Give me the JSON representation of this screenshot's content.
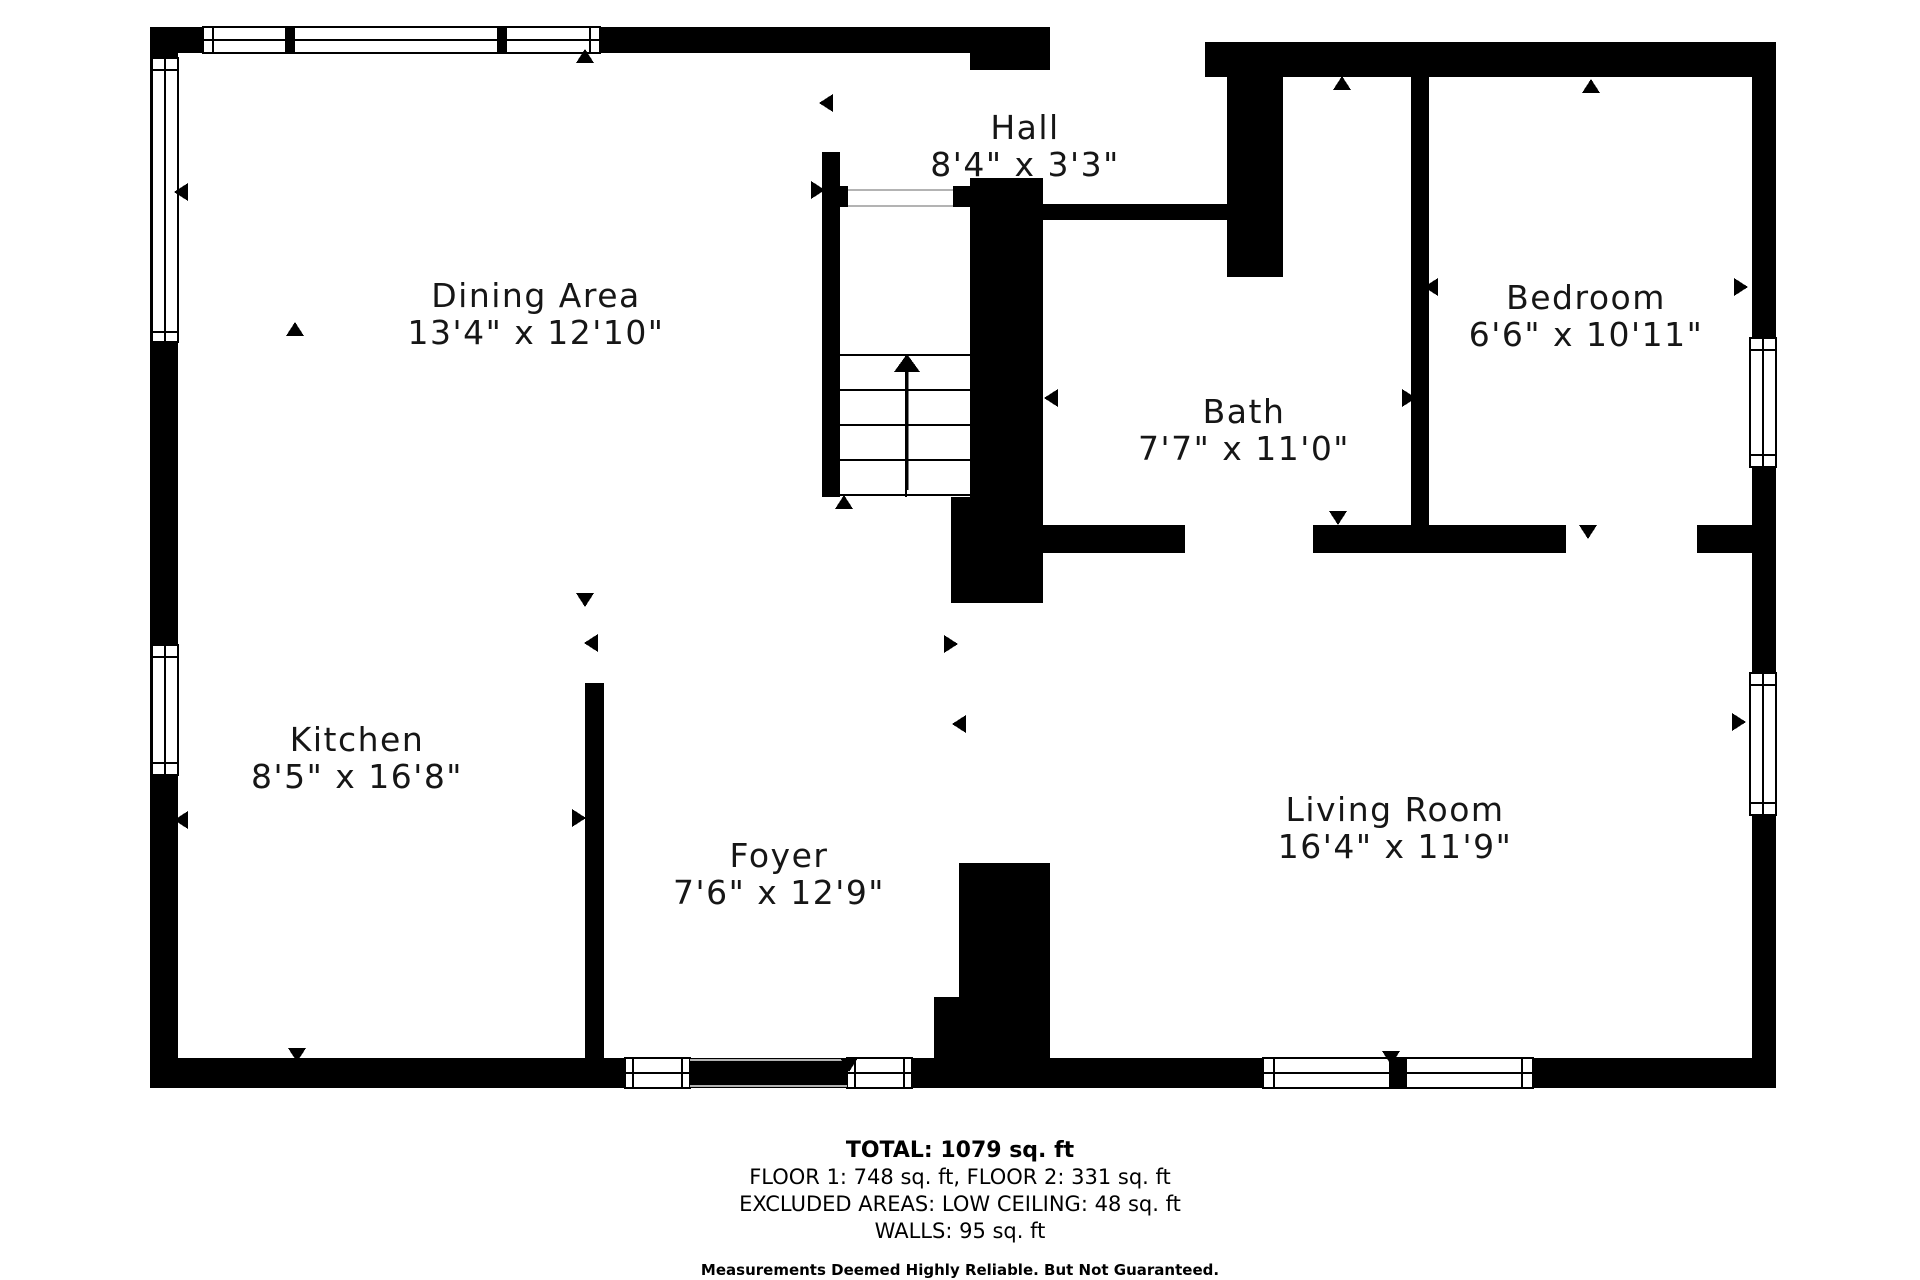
{
  "title": "Floor Plan",
  "colors": {
    "wall": "#000000",
    "background": "#ffffff",
    "opening_line": "#b3b3b3",
    "text": "#161616"
  },
  "rooms": [
    {
      "id": "dining-area",
      "name": "Dining Area",
      "dims": "13'4\" x 12'10\"",
      "cx": 536,
      "cy": 314
    },
    {
      "id": "hall",
      "name": "Hall",
      "dims": "8'4\" x 3'3\"",
      "cx": 1025,
      "cy": 146
    },
    {
      "id": "bath",
      "name": "Bath",
      "dims": "7'7\" x 11'0\"",
      "cx": 1244,
      "cy": 430
    },
    {
      "id": "bedroom",
      "name": "Bedroom",
      "dims": "6'6\" x 10'11\"",
      "cx": 1586,
      "cy": 316
    },
    {
      "id": "kitchen",
      "name": "Kitchen",
      "dims": "8'5\" x 16'8\"",
      "cx": 357,
      "cy": 758
    },
    {
      "id": "foyer",
      "name": "Foyer",
      "dims": "7'6\" x 12'9\"",
      "cx": 779,
      "cy": 874
    },
    {
      "id": "living-room",
      "name": "Living Room",
      "dims": "16'4\" x 11'9\"",
      "cx": 1395,
      "cy": 828
    }
  ],
  "footer": {
    "total": "TOTAL: 1079 sq. ft",
    "floors": "FLOOR 1: 748 sq. ft, FLOOR 2: 331 sq. ft",
    "excluded": "EXCLUDED AREAS: LOW CEILING: 48 sq. ft",
    "walls_line": "WALLS: 95 sq. ft",
    "disclaimer": "Measurements Deemed Highly Reliable. But Not Guaranteed."
  },
  "geometry": {
    "walls": [
      [
        150,
        27,
        835,
        26
      ],
      [
        970,
        27,
        80,
        43
      ],
      [
        1205,
        42,
        571,
        35
      ],
      [
        1752,
        42,
        24,
        1046
      ],
      [
        150,
        1058,
        1626,
        30
      ],
      [
        150,
        27,
        28,
        1061
      ],
      [
        822,
        152,
        18,
        345
      ],
      [
        840,
        186,
        8,
        21
      ],
      [
        953,
        186,
        17,
        21
      ],
      [
        970,
        178,
        73,
        425
      ],
      [
        951,
        497,
        19,
        106
      ],
      [
        1043,
        204,
        184,
        16
      ],
      [
        1227,
        77,
        56,
        200
      ],
      [
        1411,
        77,
        18,
        476
      ],
      [
        1043,
        525,
        142,
        28
      ],
      [
        1313,
        525,
        98,
        28
      ],
      [
        1429,
        525,
        137,
        28
      ],
      [
        1697,
        525,
        55,
        28
      ],
      [
        585,
        683,
        19,
        375
      ],
      [
        959,
        863,
        91,
        195
      ],
      [
        934,
        997,
        25,
        61
      ]
    ],
    "windows": [
      {
        "x": 203,
        "y": 27,
        "w": 397,
        "h": 26,
        "orient": "h",
        "mullions": [
          285,
          497
        ],
        "mw": 10,
        "caps": [
          213,
          590
        ]
      },
      {
        "x": 152,
        "y": 58,
        "w": 26,
        "h": 284,
        "orient": "v",
        "caps": [
          70,
          332
        ]
      },
      {
        "x": 152,
        "y": 645,
        "w": 26,
        "h": 130,
        "orient": "v",
        "caps": [
          657,
          763
        ]
      },
      {
        "x": 1750,
        "y": 338,
        "w": 26,
        "h": 129,
        "orient": "v",
        "caps": [
          350,
          455
        ]
      },
      {
        "x": 1750,
        "y": 673,
        "w": 26,
        "h": 142,
        "orient": "v",
        "caps": [
          685,
          803
        ]
      },
      {
        "x": 625,
        "y": 1058,
        "w": 65,
        "h": 30,
        "orient": "h",
        "caps": [
          633,
          682
        ]
      },
      {
        "x": 847,
        "y": 1058,
        "w": 65,
        "h": 30,
        "orient": "h",
        "caps": [
          855,
          904
        ]
      },
      {
        "x": 1263,
        "y": 1058,
        "w": 270,
        "h": 30,
        "orient": "h",
        "caps": [
          1274,
          1522
        ],
        "mullions": [
          1389
        ],
        "mw": 18
      }
    ],
    "opening_lines": [
      [
        848,
        190,
        953,
        190
      ],
      [
        848,
        206,
        953,
        206
      ],
      [
        690,
        1060,
        847,
        1060
      ],
      [
        690,
        1086,
        847,
        1086
      ]
    ],
    "stairs": {
      "x": 840,
      "w": 130,
      "treads": [
        355,
        390,
        425,
        460,
        495
      ],
      "bottom": 497,
      "center_x": 906,
      "arrow": {
        "x": 907,
        "y_tail": 490,
        "y_head": 372,
        "head_w": 26,
        "head_h": 18
      }
    },
    "door_arrows": [
      {
        "x": 827,
        "y": 103,
        "dir": "left"
      },
      {
        "x": 817,
        "y": 190,
        "dir": "right"
      },
      {
        "x": 182,
        "y": 192,
        "dir": "left"
      },
      {
        "x": 295,
        "y": 330,
        "dir": "up"
      },
      {
        "x": 585,
        "y": 57,
        "dir": "up"
      },
      {
        "x": 585,
        "y": 599,
        "dir": "down"
      },
      {
        "x": 592,
        "y": 643,
        "dir": "left"
      },
      {
        "x": 950,
        "y": 644,
        "dir": "right"
      },
      {
        "x": 960,
        "y": 724,
        "dir": "left"
      },
      {
        "x": 844,
        "y": 503,
        "dir": "up"
      },
      {
        "x": 1342,
        "y": 84,
        "dir": "up"
      },
      {
        "x": 1591,
        "y": 87,
        "dir": "up"
      },
      {
        "x": 1432,
        "y": 287,
        "dir": "left"
      },
      {
        "x": 1740,
        "y": 287,
        "dir": "right"
      },
      {
        "x": 1052,
        "y": 398,
        "dir": "left"
      },
      {
        "x": 1408,
        "y": 398,
        "dir": "right"
      },
      {
        "x": 1338,
        "y": 517,
        "dir": "down"
      },
      {
        "x": 1388,
        "y": 546,
        "dir": "up"
      },
      {
        "x": 1588,
        "y": 531,
        "dir": "down"
      },
      {
        "x": 1738,
        "y": 722,
        "dir": "right"
      },
      {
        "x": 182,
        "y": 820,
        "dir": "left"
      },
      {
        "x": 578,
        "y": 818,
        "dir": "right"
      },
      {
        "x": 297,
        "y": 1054,
        "dir": "down"
      },
      {
        "x": 849,
        "y": 1064,
        "dir": "down"
      },
      {
        "x": 1391,
        "y": 1057,
        "dir": "down"
      }
    ]
  }
}
